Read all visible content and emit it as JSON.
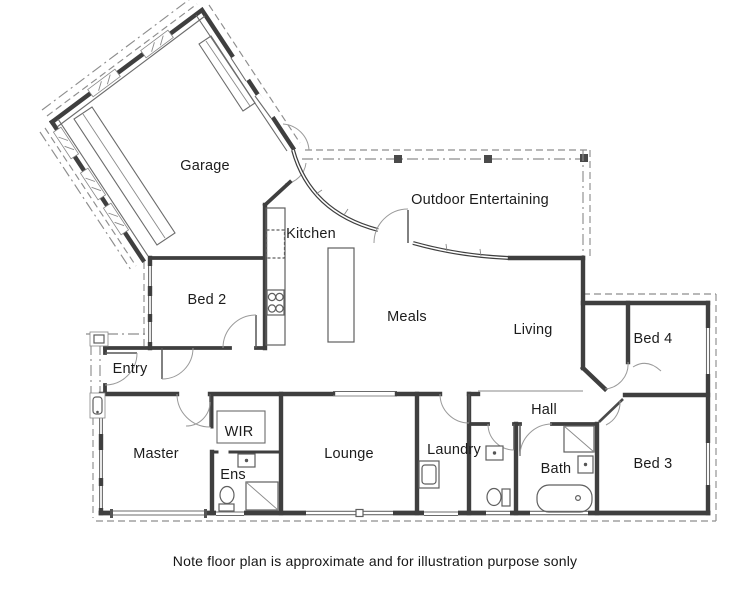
{
  "note": "Note floor plan is approximate and for illustration purpose sonly",
  "colors": {
    "wall": "#3f3f3f",
    "thin_line": "#6b6b6b",
    "dash_line": "#8d8d8d",
    "fixture": "#5f5f5f",
    "label": "#1c1c1c",
    "background": "#ffffff"
  },
  "rooms": {
    "garage": {
      "label": "Garage",
      "x": 205,
      "y": 166
    },
    "outdoor": {
      "label": "Outdoor Entertaining",
      "x": 480,
      "y": 200
    },
    "kitchen": {
      "label": "Kitchen",
      "x": 311,
      "y": 234
    },
    "bed2": {
      "label": "Bed 2",
      "x": 207,
      "y": 300
    },
    "meals": {
      "label": "Meals",
      "x": 407,
      "y": 317
    },
    "living": {
      "label": "Living",
      "x": 533,
      "y": 330
    },
    "bed4": {
      "label": "Bed 4",
      "x": 653,
      "y": 339
    },
    "entry": {
      "label": "Entry",
      "x": 130,
      "y": 369
    },
    "wir": {
      "label": "WIR",
      "x": 239,
      "y": 432
    },
    "hall": {
      "label": "Hall",
      "x": 544,
      "y": 410
    },
    "master": {
      "label": "Master",
      "x": 156,
      "y": 454
    },
    "lounge": {
      "label": "Lounge",
      "x": 349,
      "y": 454
    },
    "laundry": {
      "label": "Laundry",
      "x": 454,
      "y": 450
    },
    "bath": {
      "label": "Bath",
      "x": 556,
      "y": 469
    },
    "ens": {
      "label": "Ens",
      "x": 233,
      "y": 475
    },
    "bed3": {
      "label": "Bed 3",
      "x": 653,
      "y": 464
    }
  }
}
